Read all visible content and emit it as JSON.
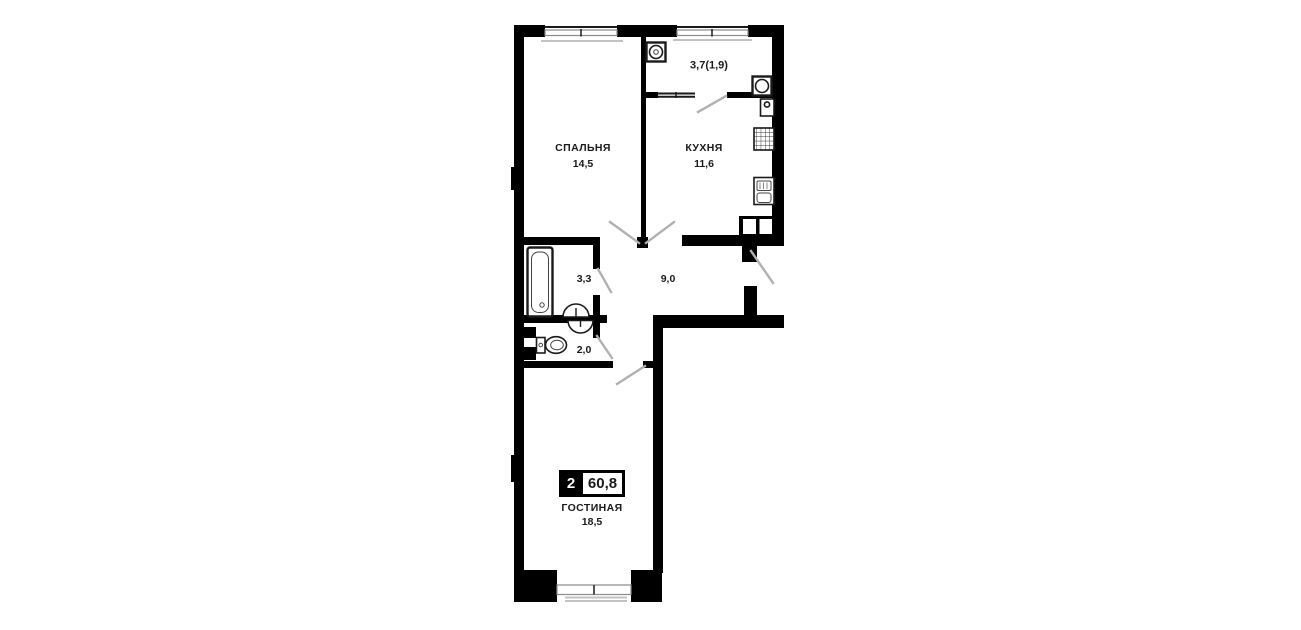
{
  "plan": {
    "badge": {
      "rooms_count": "2",
      "total_area": "60,8"
    },
    "rooms": {
      "balcony": {
        "area": "3,7(1,9)"
      },
      "bedroom": {
        "name": "СПАЛЬНЯ",
        "area": "14,5"
      },
      "kitchen": {
        "name": "КУХНЯ",
        "area": "11,6"
      },
      "bathroom": {
        "area": "3,3"
      },
      "hallway": {
        "area": "9,0"
      },
      "wc": {
        "area": "2,0"
      },
      "living_room": {
        "name": "ГОСТИНАЯ",
        "area": "18,5"
      }
    },
    "colors": {
      "wall": "#000000",
      "background": "#ffffff",
      "door": "#b0b0b0",
      "winframe": "#8a8a8a",
      "sill": "#c2c2c2",
      "text": "#1a1a1a"
    }
  }
}
